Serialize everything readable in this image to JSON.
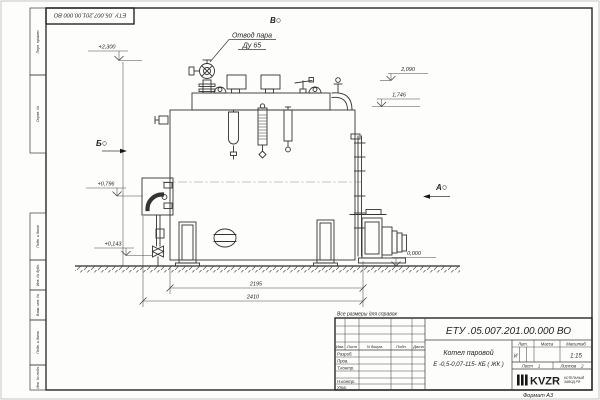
{
  "sheet": {
    "corner_designation": "ЕТУ .05.007.201.00.000  ВО",
    "format_label": "Формат А3",
    "reference_note": "Все размеры для справок",
    "margin_stamps_top": [
      "Перв. примен.",
      "Справ. №"
    ],
    "margin_stamps_bottom": [
      "Подп. и дата",
      "Инв. № дубл.",
      "Взам. инв. №",
      "Подп. и дата",
      "Инв. № подл."
    ]
  },
  "drawing": {
    "callout_steam_outlet": {
      "line1": "Отвод пара",
      "line2": "Ду 65"
    },
    "view_labels": {
      "a": "А",
      "b": "Б",
      "v": "В"
    },
    "elevations": {
      "steam_outlet": "+2,300",
      "deck_equipment": "2,090",
      "shell_top": "1,746",
      "left_connection": "+0,796",
      "drain": "+0,143",
      "ground": "0,000"
    },
    "dimensions": {
      "shell_length": "2195",
      "overall_length": "2410"
    }
  },
  "title_block": {
    "designation": "ЕТУ .05.007.201.00.000  ВО",
    "product": {
      "line1": "Котел паровой",
      "line2": "Е -0,5-0,07-115- КБ ( ЖК )"
    },
    "columns": {
      "izm": "Изм.",
      "list": "Лист",
      "doc": "N докум.",
      "podp": "Подп.",
      "data": "Дата"
    },
    "rows": {
      "developed": "Разраб.",
      "checked": "Пров.",
      "tcontrol": "Т.контр.",
      "ncontrol": "Н.контр.",
      "approved": "Утв."
    },
    "lit": {
      "header": "Лит.",
      "value": "И"
    },
    "mass": {
      "header": "Масса"
    },
    "scale": {
      "header": "Масштаб",
      "value": "1:15"
    },
    "sheet_no": {
      "label": "Лист",
      "value": "1"
    },
    "sheets_total": {
      "label": "Листов",
      "value": "2"
    },
    "company": {
      "logo": "KVZR",
      "line1": "КОТЕЛЬНЫЙ",
      "line2": "ЗАВОД РФ"
    }
  }
}
